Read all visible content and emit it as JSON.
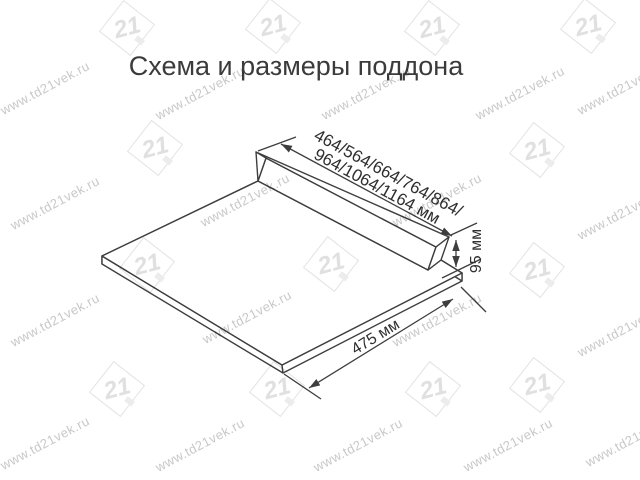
{
  "title": "Схема и размеры поддона",
  "dimensions": {
    "width_options_line1": "464/564/664/764/864/",
    "width_options_line2": "964/1064/1164 мм",
    "height": "95 мм",
    "depth": "475 мм"
  },
  "watermark": {
    "text": "www.td21vek.ru",
    "logo_text": "21",
    "text_positions": [
      [
        45,
        88
      ],
      [
        200,
        93
      ],
      [
        366,
        93
      ],
      [
        520,
        93
      ],
      [
        622,
        88
      ],
      [
        55,
        203
      ],
      [
        245,
        200
      ],
      [
        437,
        200
      ],
      [
        622,
        213
      ],
      [
        55,
        320
      ],
      [
        247,
        317
      ],
      [
        437,
        320
      ],
      [
        622,
        330
      ],
      [
        45,
        443
      ],
      [
        200,
        445
      ],
      [
        358,
        445
      ],
      [
        508,
        445
      ],
      [
        630,
        440
      ]
    ],
    "logo_positions": [
      [
        127,
        28
      ],
      [
        273,
        26
      ],
      [
        432,
        28
      ],
      [
        588,
        26
      ],
      [
        155,
        148
      ],
      [
        537,
        150
      ],
      [
        147,
        265
      ],
      [
        331,
        264
      ],
      [
        537,
        270
      ],
      [
        117,
        389
      ],
      [
        277,
        389
      ],
      [
        433,
        389
      ],
      [
        537,
        385
      ]
    ]
  },
  "colors": {
    "background": "#ffffff",
    "line": "#3e3e3e",
    "dimension_text": "#2f2f2f",
    "title_text": "#3b3b3b",
    "watermark_text": "#c8c8c8",
    "watermark_logo": "#e3e3e3"
  }
}
